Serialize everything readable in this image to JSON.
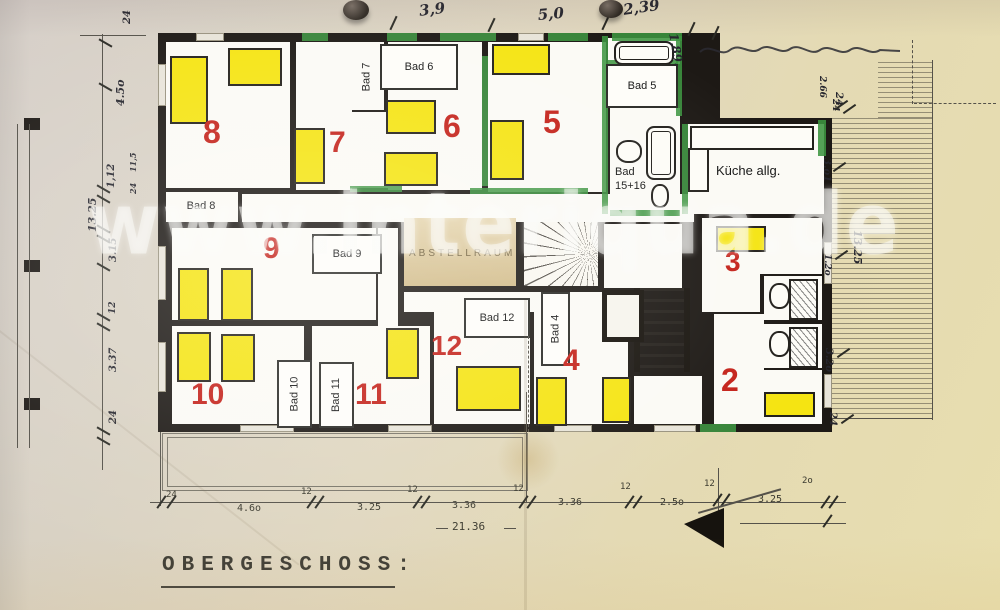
{
  "floor_title": "OBERGESCHOSS:",
  "watermark": "www.interiqua.de",
  "rooms": [
    {
      "number": "8",
      "x": 203,
      "y": 116,
      "size": 32
    },
    {
      "number": "7",
      "x": 329,
      "y": 128,
      "size": 30
    },
    {
      "number": "6",
      "x": 443,
      "y": 110,
      "size": 32
    },
    {
      "number": "5",
      "x": 543,
      "y": 106,
      "size": 32
    },
    {
      "number": "9",
      "x": 263,
      "y": 234,
      "size": 30
    },
    {
      "number": "10",
      "x": 191,
      "y": 380,
      "size": 30
    },
    {
      "number": "11",
      "x": 355,
      "y": 380,
      "size": 30
    },
    {
      "number": "12",
      "x": 431,
      "y": 332,
      "size": 28
    },
    {
      "number": "4",
      "x": 563,
      "y": 346,
      "size": 30
    },
    {
      "number": "3",
      "x": 725,
      "y": 248,
      "size": 28
    },
    {
      "number": "2",
      "x": 721,
      "y": 364,
      "size": 32
    }
  ],
  "bath_boxes": [
    {
      "t": "Bad 6",
      "x": 380,
      "y": 44,
      "w": 74,
      "h": 42,
      "v": 0,
      "b": 1
    },
    {
      "t": "Bad 5",
      "x": 606,
      "y": 64,
      "w": 68,
      "h": 40,
      "v": 0,
      "b": 1
    },
    {
      "t": "Bad 9",
      "x": 312,
      "y": 234,
      "w": 66,
      "h": 36,
      "v": 0,
      "b": 1
    },
    {
      "t": "Bad 12",
      "x": 464,
      "y": 298,
      "w": 62,
      "h": 36,
      "v": 0,
      "b": 1
    },
    {
      "t": "Bad 10",
      "x": 277,
      "y": 360,
      "w": 31,
      "h": 64,
      "v": 1,
      "b": 1
    },
    {
      "t": "Bad 11",
      "x": 319,
      "y": 362,
      "w": 31,
      "h": 62,
      "v": 1,
      "b": 1
    },
    {
      "t": "Bad 4",
      "x": 541,
      "y": 292,
      "w": 25,
      "h": 70,
      "v": 1,
      "b": 1
    },
    {
      "t": "Bad 7",
      "x": 350,
      "y": 44,
      "w": 32,
      "h": 66,
      "v": 1,
      "b": 0
    },
    {
      "t": "Bad 8",
      "x": 168,
      "y": 192,
      "w": 66,
      "h": 28,
      "v": 0,
      "b": 0
    }
  ],
  "plain_labels": [
    {
      "t": "Bad\n15+16",
      "x": 615,
      "y": 166,
      "s": 11,
      "ls": 0,
      "c": "#151515"
    },
    {
      "t": "Küche allg.",
      "x": 716,
      "y": 163,
      "s": 13,
      "ls": 0,
      "c": "#151515"
    },
    {
      "t": "ABSTELLRAUM",
      "x": 409,
      "y": 248,
      "s": 10,
      "ls": 3,
      "c": "rgba(92,76,44,0.85)"
    }
  ],
  "beds": [
    [
      170,
      56,
      34,
      64
    ],
    [
      228,
      48,
      50,
      34
    ],
    [
      294,
      128,
      27,
      52
    ],
    [
      386,
      100,
      46,
      30
    ],
    [
      384,
      152,
      50,
      30
    ],
    [
      492,
      44,
      54,
      27
    ],
    [
      490,
      120,
      30,
      56
    ],
    [
      716,
      226,
      46,
      22
    ],
    [
      764,
      392,
      47,
      21
    ],
    [
      178,
      268,
      27,
      49
    ],
    [
      221,
      268,
      28,
      49
    ],
    [
      177,
      332,
      30,
      46
    ],
    [
      221,
      334,
      30,
      44
    ],
    [
      386,
      328,
      29,
      47
    ],
    [
      456,
      366,
      61,
      41
    ],
    [
      536,
      377,
      27,
      45
    ],
    [
      602,
      377,
      25,
      42
    ]
  ],
  "dimensions": {
    "top": [
      {
        "t": "3,9",
        "x": 418,
        "y": 2,
        "r": -7,
        "s": 15
      },
      {
        "t": "5,0",
        "x": 537,
        "y": 6,
        "r": -5,
        "s": 15
      },
      {
        "t": "2,39",
        "x": 622,
        "y": 1,
        "r": -8,
        "s": 15
      },
      {
        "t": "1,89.",
        "x": 680,
        "y": 32,
        "r": 80,
        "s": 12
      },
      {
        "t": "2.66",
        "x": 827,
        "y": 76,
        "r": 90,
        "s": 9
      },
      {
        "t": "24",
        "x": 840,
        "y": 99,
        "r": 90,
        "s": 9
      }
    ],
    "bottom": [
      {
        "t": "24",
        "x": 166,
        "y": 490,
        "r": 0,
        "s": 9
      },
      {
        "t": "4.6o",
        "x": 237,
        "y": 503,
        "r": 0,
        "s": 10
      },
      {
        "t": "12",
        "x": 301,
        "y": 487,
        "r": 0,
        "s": 9
      },
      {
        "t": "3.25",
        "x": 357,
        "y": 502,
        "r": 0,
        "s": 10
      },
      {
        "t": "12",
        "x": 407,
        "y": 485,
        "r": 0,
        "s": 9
      },
      {
        "t": "3.36",
        "x": 452,
        "y": 500,
        "r": 0,
        "s": 10
      },
      {
        "t": "12",
        "x": 513,
        "y": 484,
        "r": 0,
        "s": 9
      },
      {
        "t": "3.36",
        "x": 558,
        "y": 497,
        "r": 0,
        "s": 10
      },
      {
        "t": "12",
        "x": 620,
        "y": 482,
        "r": 0,
        "s": 9
      },
      {
        "t": "2.5o",
        "x": 660,
        "y": 497,
        "r": 0,
        "s": 10
      },
      {
        "t": "12",
        "x": 704,
        "y": 479,
        "r": 0,
        "s": 9
      },
      {
        "t": "3.25",
        "x": 758,
        "y": 494,
        "r": 0,
        "s": 10
      },
      {
        "t": "2o",
        "x": 802,
        "y": 476,
        "r": 0,
        "s": 9
      },
      {
        "t": "21.36",
        "x": 452,
        "y": 520,
        "r": 0,
        "s": 11
      }
    ],
    "left": [
      {
        "t": "24",
        "x": 122,
        "y": 24,
        "r": -90,
        "s": 10
      },
      {
        "t": "4.5o",
        "x": 114,
        "y": 106,
        "r": -90,
        "s": 11
      },
      {
        "t": "11,5",
        "x": 128,
        "y": 172,
        "r": -90,
        "s": 8
      },
      {
        "t": "24",
        "x": 128,
        "y": 194,
        "r": -90,
        "s": 8
      },
      {
        "t": "1,12",
        "x": 106,
        "y": 188,
        "r": -90,
        "s": 10
      },
      {
        "t": "13.25",
        "x": 86,
        "y": 232,
        "r": -90,
        "s": 11
      },
      {
        "t": "3.15",
        "x": 108,
        "y": 262,
        "r": -90,
        "s": 10
      },
      {
        "t": "12",
        "x": 108,
        "y": 314,
        "r": -90,
        "s": 9
      },
      {
        "t": "3.37",
        "x": 108,
        "y": 372,
        "r": -90,
        "s": 10
      },
      {
        "t": "24",
        "x": 108,
        "y": 424,
        "r": -90,
        "s": 10
      }
    ],
    "right": [
      {
        "t": "24",
        "x": 844,
        "y": 92,
        "r": 90,
        "s": 10
      },
      {
        "t": "3.o1",
        "x": 832,
        "y": 158,
        "r": 90,
        "s": 10
      },
      {
        "t": "13.25",
        "x": 864,
        "y": 230,
        "r": 90,
        "s": 11
      },
      {
        "t": "1.2o",
        "x": 832,
        "y": 254,
        "r": 90,
        "s": 9
      },
      {
        "t": "3.2o",
        "x": 834,
        "y": 348,
        "r": 90,
        "s": 10
      },
      {
        "t": "24",
        "x": 838,
        "y": 412,
        "r": 90,
        "s": 10
      }
    ]
  }
}
